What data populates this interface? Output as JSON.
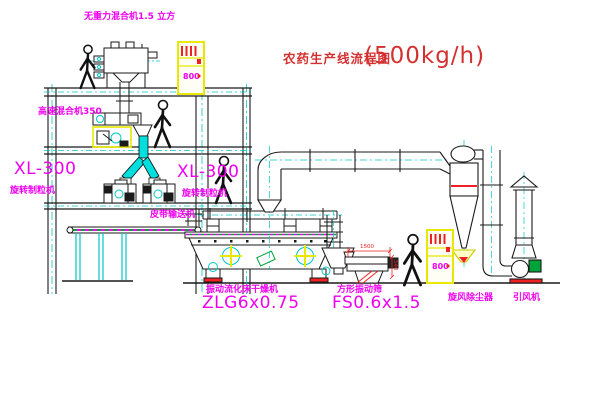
{
  "title": {
    "text": "农药生产线流程图",
    "capacity": "(500kg/h)"
  },
  "equipment_labels": {
    "gravity_mixer": "无重力混合机1.5 立方",
    "high_speed_mixer": "高速混合机350",
    "granulator_left": {
      "model": "XL-300",
      "name": "旋转制粒机"
    },
    "granulator_right": {
      "model": "XL-300",
      "name": "旋转制粒机"
    },
    "belt_conveyor": "皮带输送机",
    "fluid_bed_dryer": {
      "name": "振动流化床干燥机",
      "model": "ZLG6x0.75"
    },
    "vibrating_sieve": {
      "name": "方形振动筛",
      "model": "FS0.6x1.5"
    },
    "cyclone": "旋风除尘器",
    "induced_draft_fan": "引风机"
  },
  "dimensions": {
    "sieve_length": "1500",
    "sieve_height": "540"
  },
  "cabinets": {
    "cabinet1_display": "800",
    "cabinet2_display": "800"
  },
  "colors": {
    "label_magenta": "#ee00ee",
    "title_red": "#d43030",
    "line_black": "#1a1a1a",
    "centerline_cyan": "#00c8c8",
    "cabinet_yellow": "#e8e800",
    "accent_red": "#ee2222",
    "accent_green": "#00a33a"
  }
}
